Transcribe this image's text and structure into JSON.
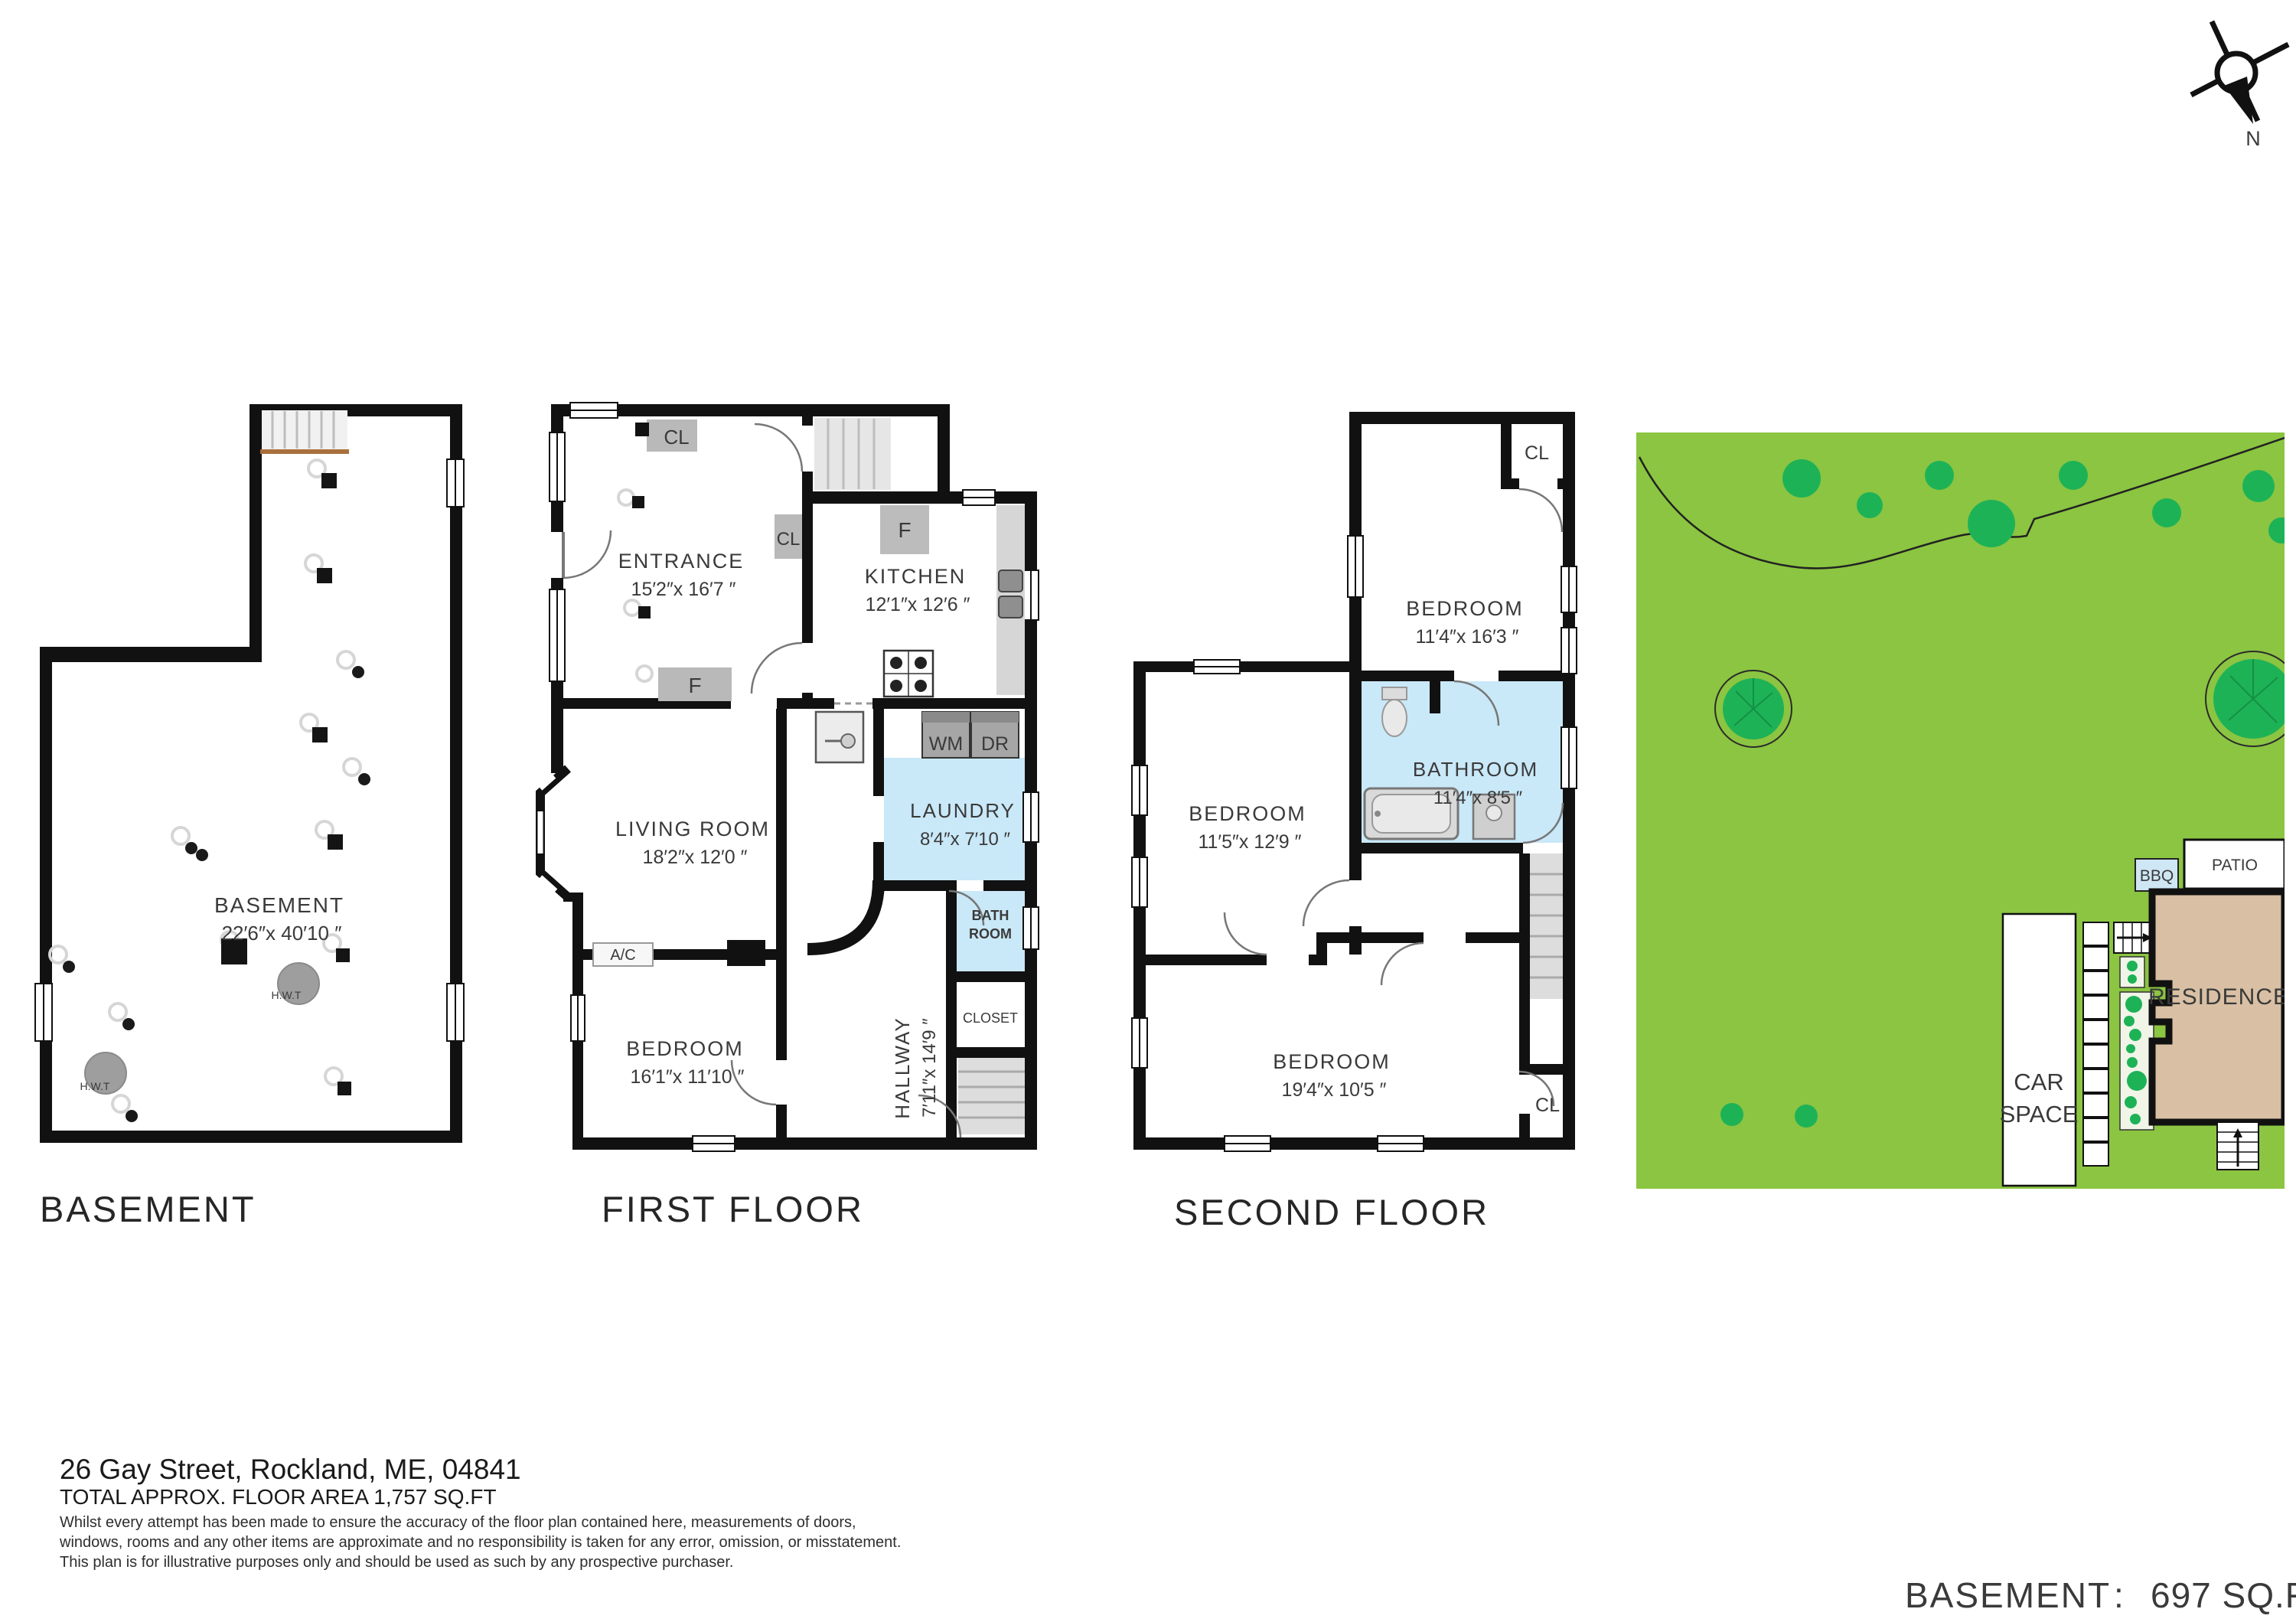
{
  "compass": {
    "north": "N"
  },
  "basement": {
    "title": "BASEMENT",
    "room": "BASEMENT",
    "dims": "22′6″x 40′10 ″",
    "hwt1": "H.W.T",
    "hwt2": "H.W.T"
  },
  "first": {
    "title": "FIRST FLOOR",
    "entrance": "ENTRANCE",
    "entrance_dims": "15′2″x 16′7 ″",
    "kitchen": "KITCHEN",
    "kitchen_dims": "12′1″x 12′6 ″",
    "living": "LIVING ROOM",
    "living_dims": "18′2″x 12′0 ″",
    "laundry": "LAUNDRY",
    "laundry_dims": "8′4″x 7′10 ″",
    "bedroom": "BEDROOM",
    "bedroom_dims": "16′1″x 11′10 ″",
    "hallway": "HALLWAY",
    "hallway_dims": "7′11″x 14′9 ″",
    "cl_top": "CL",
    "cl_mid": "CL",
    "f_entrance": "F",
    "f_kitchen": "F",
    "wm": "WM",
    "dr": "DR",
    "bath1": "BATH",
    "bath2": "ROOM",
    "closet": "CLOSET",
    "ac": "A/C"
  },
  "second": {
    "title": "SECOND FLOOR",
    "bedroom_top": "BEDROOM",
    "bedroom_top_dims": "11′4″x 16′3 ″",
    "bathroom": "BATHROOM",
    "bathroom_dims": "11′4″x 8′5 ″",
    "bedroom_left": "BEDROOM",
    "bedroom_left_dims": "11′5″x 12′9 ″",
    "bedroom_bottom": "BEDROOM",
    "bedroom_bottom_dims": "19′4″x 10′5 ″",
    "cl_top": "CL",
    "cl_bottom": "CL"
  },
  "site": {
    "car1": "CAR",
    "car2": "SPACE",
    "residence": "RESIDENCE",
    "patio": "PATIO",
    "bbq": "BBQ"
  },
  "footer": {
    "address": "26 Gay Street, Rockland, ME, 04841",
    "total": "TOTAL APPROX. FLOOR AREA 1,757 SQ.FT",
    "disc1": "Whilst every attempt has been made to ensure the accuracy of the floor plan contained here, measurements of doors,",
    "disc2": "windows, rooms and any other items are approximate and no responsibility is taken for any error, omission, or misstatement.",
    "disc3": "This plan is for illustrative purposes only and should be used as such by any prospective purchaser.",
    "area_label": "BASEMENT",
    "area_sep": ":",
    "area_value": "697 SQ.FT"
  },
  "colors": {
    "wall": "#111111",
    "wet_room": "#c9e8f8",
    "grass": "#8bc541",
    "shrub": "#1eb257",
    "residence_fill": "#d9c0a4",
    "stair_fill": "#e3e3e3"
  }
}
